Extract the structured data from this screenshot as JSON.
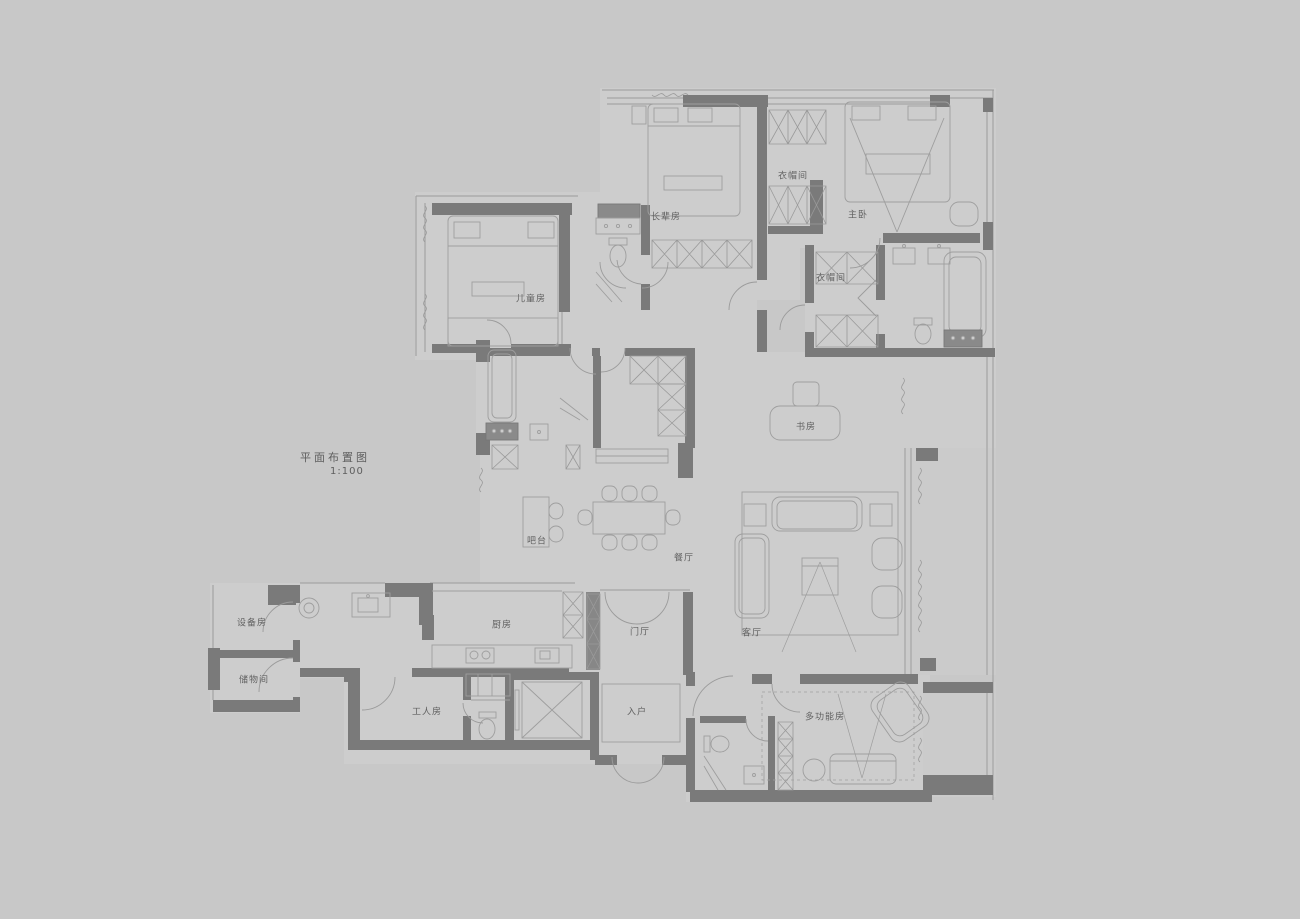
{
  "title_block": {
    "title": "平面布置图",
    "scale": "1:100"
  },
  "rooms": [
    {
      "id": "children-room",
      "label": "儿童房"
    },
    {
      "id": "elder-room",
      "label": "长辈房"
    },
    {
      "id": "cloakroom-a",
      "label": "衣帽间"
    },
    {
      "id": "master-bedroom",
      "label": "主卧"
    },
    {
      "id": "cloakroom-b",
      "label": "衣帽间"
    },
    {
      "id": "study",
      "label": "书房"
    },
    {
      "id": "bar-counter",
      "label": "吧台"
    },
    {
      "id": "dining-room",
      "label": "餐厅"
    },
    {
      "id": "living-room",
      "label": "客厅"
    },
    {
      "id": "kitchen",
      "label": "厨房"
    },
    {
      "id": "foyer",
      "label": "门厅"
    },
    {
      "id": "equipment-room",
      "label": "设备房"
    },
    {
      "id": "storage-room",
      "label": "储物间"
    },
    {
      "id": "worker-room",
      "label": "工人房"
    },
    {
      "id": "entry",
      "label": "入户"
    },
    {
      "id": "multi-function-room",
      "label": "多功能房"
    }
  ],
  "colors": {
    "background": "#c8c8c8",
    "floor": "#cdcdcd",
    "wall": "#7a7a7a",
    "furniture_line": "#9e9e9e",
    "text": "#616161"
  },
  "drawing": {
    "type": "residential floor plan",
    "scale_ratio": "1:100"
  }
}
